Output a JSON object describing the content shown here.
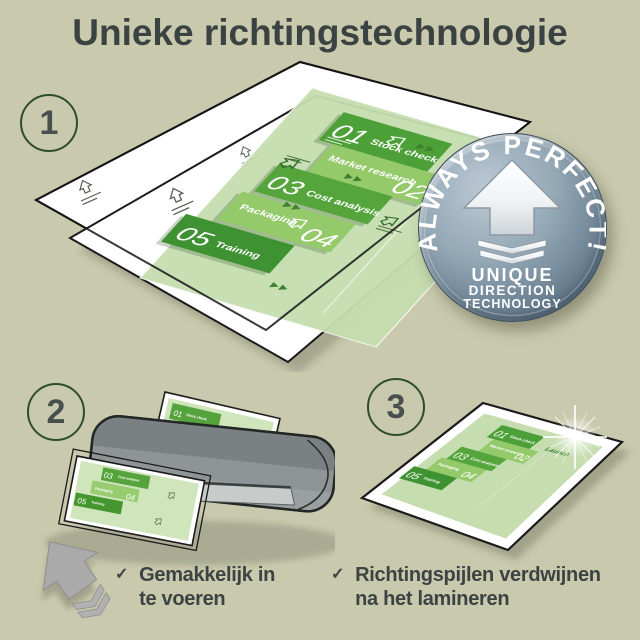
{
  "page": {
    "title": "Unieke richtingstechnologie",
    "background_color": "#c9c9ad"
  },
  "steps": {
    "one": "1",
    "two": "2",
    "three": "3"
  },
  "doc": {
    "items": [
      {
        "num": "01",
        "label": "Stock check"
      },
      {
        "num": "02",
        "label": "Market research"
      },
      {
        "num": "03",
        "label": "Cost analysis"
      },
      {
        "num": "04",
        "label": "Packaging"
      },
      {
        "num": "05",
        "label": "Training"
      }
    ],
    "launch": "Launch"
  },
  "badge": {
    "arc": "ALWAYS PERFECT!",
    "line1": "UNIQUE",
    "line2": "DIRECTION",
    "line3": "TECHNOLOGY"
  },
  "checklist": {
    "check": "✓",
    "item1_line1": "Gemakkelijk in",
    "item1_line2": "te voeren",
    "item2_line1": "Richtingspijlen verdwijnen",
    "item2_line2": "na het lamineren"
  },
  "colors": {
    "block_dark_green": "#4da037",
    "block_mid_green": "#94ca6a",
    "doc_light_green": "#c6deb0",
    "launch_green": "#3c8030",
    "badge_blue_gray": "#62788a",
    "machine_gray": "#8f9596",
    "text_dark": "#3c4343"
  }
}
